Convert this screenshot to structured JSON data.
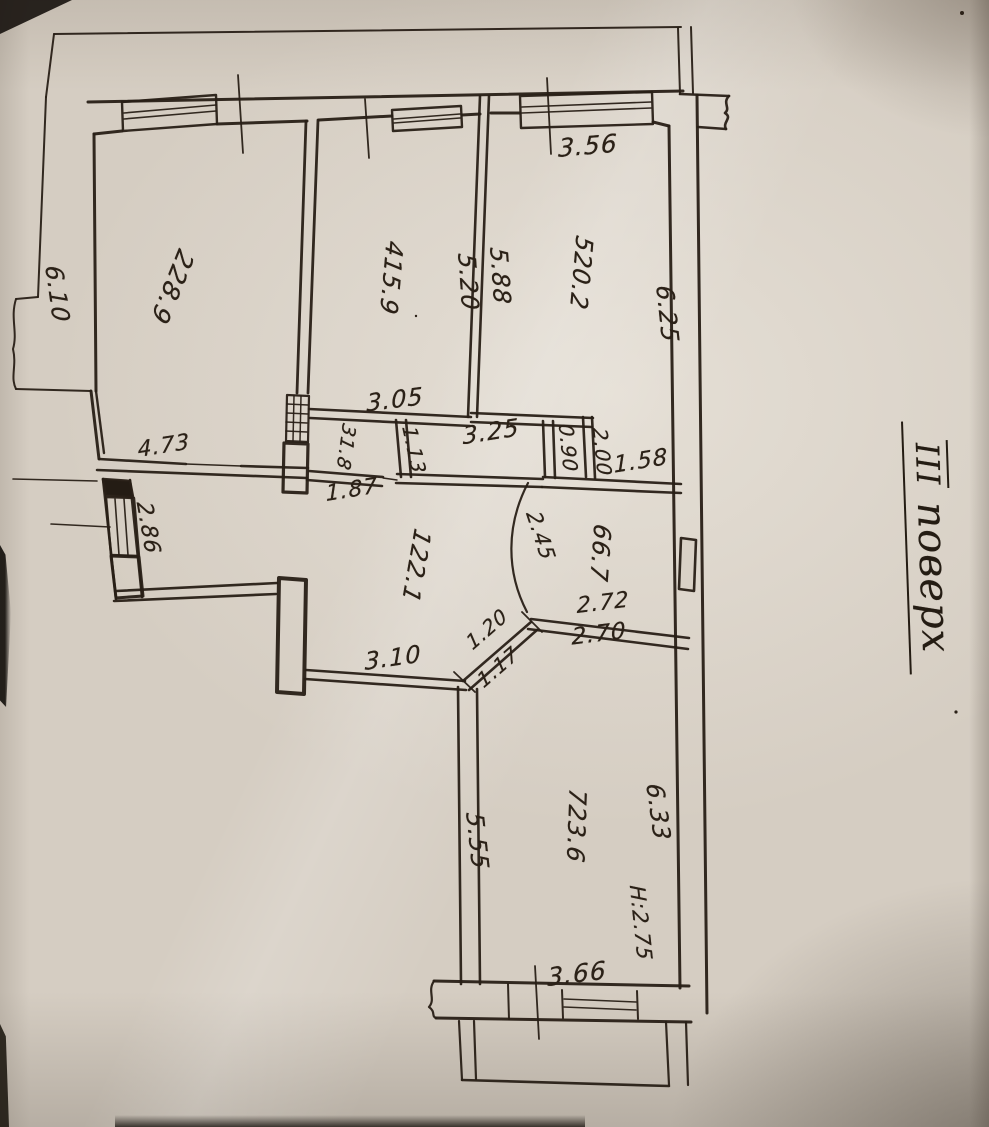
{
  "floor_title": {
    "numeral": "ІІІ",
    "word": "поверх"
  },
  "rooms": [
    {
      "number": "1",
      "area": "22.1"
    },
    {
      "number": "2",
      "area": "28.9"
    },
    {
      "number": "3",
      "area": "1.8"
    },
    {
      "number": "4",
      "area": "15.9"
    },
    {
      "number": "5",
      "area": "20.2"
    },
    {
      "number": "6",
      "area": "6.7"
    },
    {
      "number": "7",
      "area": "23.6"
    }
  ],
  "height_mark": "H:2.75",
  "colors": {
    "ink": "#281f16",
    "paper": "#d5cdc2"
  },
  "labels": [
    {
      "kind": "dim",
      "name": "dim-3-56",
      "text": "3.56",
      "x": 588,
      "y": 146,
      "rot": -5,
      "fs": 25
    },
    {
      "kind": "dim",
      "name": "dim-6-25",
      "text": "6.25",
      "x": 667,
      "y": 314,
      "rot": 84,
      "fs": 24
    },
    {
      "kind": "dim",
      "name": "dim-5-20",
      "text": "5.20",
      "x": 468,
      "y": 282,
      "rot": 86,
      "fs": 24
    },
    {
      "kind": "dim",
      "name": "dim-5-88",
      "text": "5.88",
      "x": 500,
      "y": 276,
      "rot": 86,
      "fs": 24
    },
    {
      "kind": "dim",
      "name": "dim-6-10",
      "text": "6.10",
      "x": 57,
      "y": 294,
      "rot": 82,
      "fs": 24
    },
    {
      "kind": "dim",
      "name": "dim-3-05",
      "text": "3.05",
      "x": 395,
      "y": 400,
      "rot": -7,
      "fs": 24
    },
    {
      "kind": "dim",
      "name": "dim-1-13",
      "text": "1.13",
      "x": 414,
      "y": 450,
      "rot": 78,
      "fs": 20
    },
    {
      "kind": "dim",
      "name": "dim-3-25",
      "text": "3.25",
      "x": 491,
      "y": 432,
      "rot": -9,
      "fs": 24
    },
    {
      "kind": "dim",
      "name": "dim-1-87",
      "text": "1.87",
      "x": 352,
      "y": 491,
      "rot": -9,
      "fs": 22
    },
    {
      "kind": "dim",
      "name": "dim-4-73",
      "text": "4.73",
      "x": 164,
      "y": 447,
      "rot": -9,
      "fs": 22
    },
    {
      "kind": "dim",
      "name": "dim-2-86",
      "text": "2.86",
      "x": 147,
      "y": 528,
      "rot": 80,
      "fs": 22
    },
    {
      "kind": "dim",
      "name": "dim-0-90",
      "text": "0.90",
      "x": 568,
      "y": 448,
      "rot": 84,
      "fs": 20
    },
    {
      "kind": "dim",
      "name": "dim-2-00",
      "text": "2.00",
      "x": 602,
      "y": 452,
      "rot": 84,
      "fs": 20
    },
    {
      "kind": "dim",
      "name": "dim-1-58",
      "text": "1.58",
      "x": 641,
      "y": 462,
      "rot": -9,
      "fs": 23
    },
    {
      "kind": "dim",
      "name": "dim-2-45",
      "text": "2.45",
      "x": 540,
      "y": 536,
      "rot": 72,
      "fs": 21
    },
    {
      "kind": "dim",
      "name": "dim-2-72",
      "text": "2.72",
      "x": 603,
      "y": 604,
      "rot": -7,
      "fs": 22
    },
    {
      "kind": "dim",
      "name": "dim-2-70",
      "text": "2.70",
      "x": 599,
      "y": 635,
      "rot": -7,
      "fs": 23
    },
    {
      "kind": "dim",
      "name": "dim-3-10",
      "text": "3.10",
      "x": 393,
      "y": 658,
      "rot": -8,
      "fs": 24
    },
    {
      "kind": "dim",
      "name": "dim-1-20",
      "text": "1.20",
      "x": 487,
      "y": 629,
      "rot": -41,
      "fs": 20
    },
    {
      "kind": "dim",
      "name": "dim-1-17",
      "text": "1.17",
      "x": 498,
      "y": 667,
      "rot": -41,
      "fs": 20
    },
    {
      "kind": "dim",
      "name": "dim-5-55",
      "text": "5.55",
      "x": 477,
      "y": 841,
      "rot": 84,
      "fs": 24
    },
    {
      "kind": "dim",
      "name": "dim-6-33",
      "text": "6.33",
      "x": 658,
      "y": 812,
      "rot": 82,
      "fs": 24
    },
    {
      "kind": "dim",
      "name": "dim-h-2-75",
      "text": "H:2.75",
      "x": 640,
      "y": 923,
      "rot": 84,
      "fs": 21
    },
    {
      "kind": "dim",
      "name": "dim-3-66",
      "text": "3.66",
      "x": 577,
      "y": 974,
      "rot": -7,
      "fs": 25
    },
    {
      "kind": "room",
      "name": "room-label-2",
      "num": "2",
      "den": "28.9",
      "x": 172,
      "y": 287,
      "rot": 112,
      "fs": 25
    },
    {
      "kind": "room",
      "name": "room-label-4",
      "num": "4",
      "den": "15.9",
      "x": 391,
      "y": 278,
      "rot": 95,
      "fs": 24
    },
    {
      "kind": "room",
      "name": "room-label-5",
      "num": "5",
      "den": "20.2",
      "x": 581,
      "y": 273,
      "rot": 95,
      "fs": 24
    },
    {
      "kind": "room",
      "name": "room-label-3",
      "num": "3",
      "den": "1.8",
      "x": 345,
      "y": 447,
      "rot": 98,
      "fs": 19
    },
    {
      "kind": "room",
      "name": "room-label-1",
      "num": "1",
      "den": "22.1",
      "x": 416,
      "y": 566,
      "rot": 100,
      "fs": 24
    },
    {
      "kind": "room",
      "name": "room-label-6",
      "num": "6",
      "den": "6.7",
      "x": 600,
      "y": 553,
      "rot": 94,
      "fs": 24
    },
    {
      "kind": "room",
      "name": "room-label-7",
      "num": "7",
      "den": "23.6",
      "x": 576,
      "y": 826,
      "rot": 92,
      "fs": 24
    },
    {
      "kind": "title",
      "name": "floor-title",
      "x": 930,
      "y": 547,
      "rot": 88,
      "fs": 40
    }
  ]
}
